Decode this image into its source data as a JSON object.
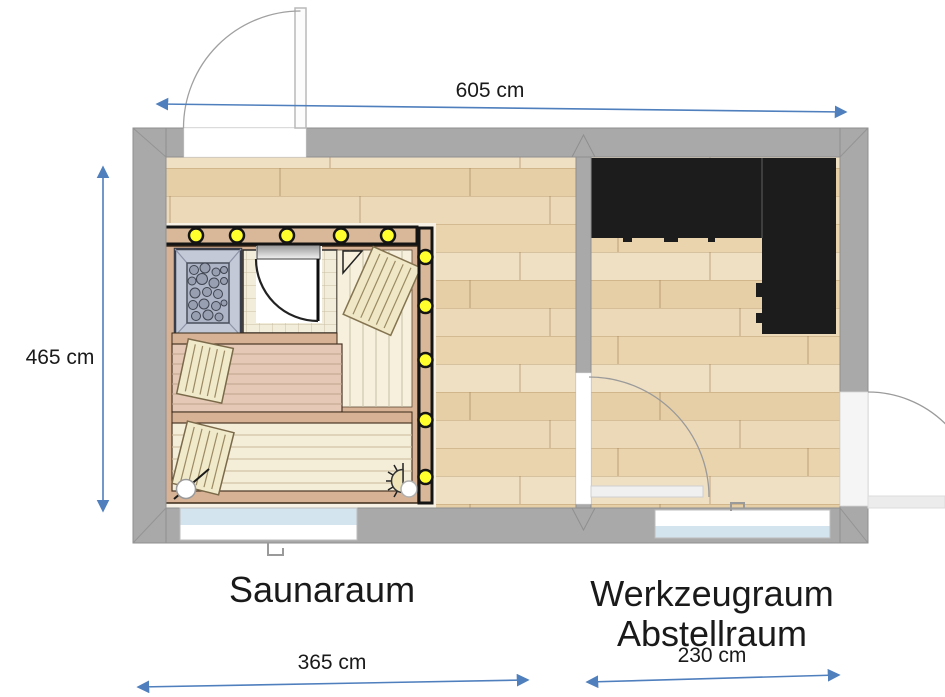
{
  "labels": {
    "room_sauna": "Saunaraum",
    "room_storage_line1": "Werkzeugraum",
    "room_storage_line2": "Abstellraum"
  },
  "dimensions": {
    "total_width": "605 cm",
    "total_depth": "465 cm",
    "sauna_room_width": "365 cm",
    "storage_room_width": "230 cm"
  },
  "plan": {
    "overall": {
      "width_cm": 605,
      "depth_cm": 465
    },
    "rooms": [
      {
        "name": "Saunaraum",
        "width_cm": 365
      },
      {
        "name": "Werkzeugraum Abstellraum",
        "width_cm": 230
      }
    ],
    "features": {
      "sauna_ceiling_lights": 5,
      "sauna_side_lights": 5,
      "exterior_doors": 2,
      "interior_doors": 2,
      "windows": 2,
      "heater": "sauna stone heater (top-left of sauna)",
      "benches": 2,
      "headrests": 3,
      "worktop": "L-shaped black counter along top and right wall of storage room",
      "wall_lamp": "sauna wall lamp bottom-right"
    }
  },
  "colors": {
    "wall_gray": "#a9a9a9",
    "floor_wood": "#ead6b2",
    "counter_black": "#1c1c1c",
    "sauna_frame_tan": "#d8b294",
    "bench_pink": "#e5c9b6",
    "bench_cream": "#f4edd8",
    "heater_blue_gray": "#c3c9d7",
    "light_yellow": "#ffff2e",
    "dimension_blue": "#4f7fbd",
    "window_blue": "#d4e4ee",
    "text_black": "#1a1a1a"
  }
}
